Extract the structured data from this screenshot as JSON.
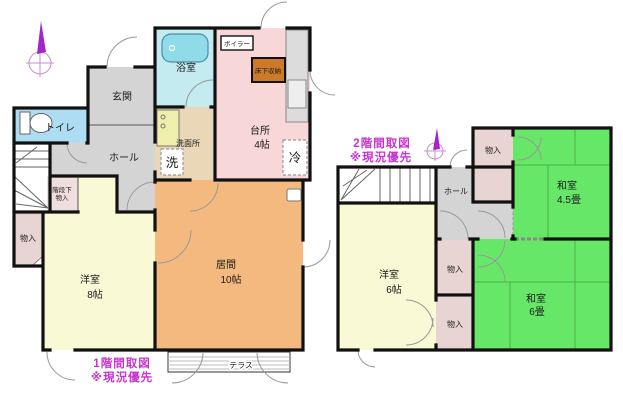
{
  "floor1": {
    "caption_line1": "1階間取図",
    "caption_line2": "※現況優先",
    "rooms": {
      "bathroom": "浴室",
      "boiler": "ボイラー",
      "underfloor_storage": "床下収納",
      "kitchen_name": "台所",
      "kitchen_size": "4帖",
      "fridge": "冷",
      "entrance": "玄関",
      "toilet": "トイレ",
      "hall": "ホール",
      "washroom": "洗面所",
      "washer": "洗",
      "under_stairs_line1": "階段下",
      "under_stairs_line2": "物入",
      "storage_left": "物入",
      "western_name": "洋室",
      "western_size": "8帖",
      "living_name": "居間",
      "living_size": "10帖",
      "terrace": "テラス"
    }
  },
  "floor2": {
    "caption_line1": "2階間取図",
    "caption_line2": "※現況優先",
    "rooms": {
      "hall": "ホール",
      "closet_top": "物入",
      "washitsu45_name": "和室",
      "washitsu45_size": "4.5畳",
      "western_name": "洋室",
      "western_size": "6帖",
      "closet_mid": "物入",
      "closet_bottom": "物入",
      "washitsu6_name": "和室",
      "washitsu6_size": "6畳"
    }
  },
  "colors": {
    "wall": "#111111",
    "bathroom": "#c3ebf0",
    "kitchen": "#f7d7d7",
    "gray_room": "#d4d4d4",
    "toilet": "#aedcf2",
    "washroom": "#e9d7b8",
    "western_room": "#f9f9d5",
    "living_room": "#f3b97e",
    "closet": "#e8d5d3",
    "tatami_green": "#67e767",
    "underfloor_box": "#cd7a28",
    "caption_magenta": "#c733cc"
  }
}
